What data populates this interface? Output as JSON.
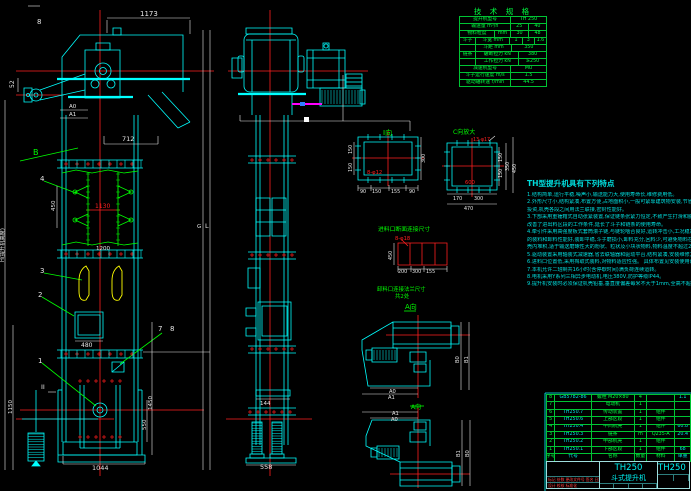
{
  "colors": {
    "background": "#000000",
    "line_cyan": "#00ffff",
    "line_green": "#00ff00",
    "line_red": "#ff1f1f",
    "line_yellow": "#ffff00",
    "line_magenta": "#ff00ff",
    "dim_white": "#e8e8e8",
    "table_green": "#00ff41"
  },
  "tech_table": {
    "title": "技 术 规 格",
    "rows": [
      [
        [
          "提升机型号",
          13
        ],
        [
          "TH 250",
          9
        ]
      ],
      [
        [
          "输送量 m³/h",
          13
        ],
        [
          "25",
          4.5
        ],
        [
          "40",
          4.5
        ]
      ],
      [
        [
          "物料粒度",
          9
        ],
        [
          "mm",
          4
        ],
        [
          "30",
          4.5
        ],
        [
          "48",
          4.5
        ]
      ],
      [
        [
          "斗子",
          4
        ],
        [
          "斗宽 mm",
          9
        ],
        [
          "1",
          3
        ],
        [
          "3",
          3
        ],
        [
          "1.6",
          3
        ]
      ],
      [
        [
          "",
          4
        ],
        [
          "斗距 mm",
          9
        ],
        [
          "350",
          9
        ]
      ],
      [
        [
          "链条",
          4
        ],
        [
          "破断拉力 kN",
          11
        ],
        [
          "380",
          7
        ]
      ],
      [
        [
          "",
          4
        ],
        [
          "工作拉力 kN",
          11
        ],
        [
          "≥250",
          7
        ]
      ],
      [
        [
          "减速机型号",
          13
        ],
        [
          "MU",
          9
        ]
      ],
      [
        [
          "斗子运行速度 m/s",
          13
        ],
        [
          "1.5",
          9
        ]
      ],
      [
        [
          "驱动轴转速 r/min",
          13
        ],
        [
          "44.5",
          9
        ]
      ]
    ]
  },
  "features": {
    "title": "TH型提升机具有下列特点",
    "lines": [
      "1.结构简单,运行平稳,噪声小,输送能力大,使用寿命长,维修费用低。",
      "2.外形尺寸小,结构紧凑,布置方便,占地面积小,一般可紧靠建筑物安装,节省基建",
      "  投资,机壳各段之间用法兰联接,密封性能好。",
      "3.下部采用重锤箱式自动张紧装置,保证链条张紧力恒定,不致产生打滑和脱链,大大",
      "  改善了进出料区段的工作条件,延长了斗子和链条的使用寿命。",
      "4.牵引件采用高强度板式套筒滚子链,与链轮啮合良好,运转冲击小,工况稳定。斗子",
      "  的装料和卸料性能好,装卸平稳,斗子磨损小,卸料充分,回料少,可避免物料在机",
      "  壳内堆积,适于输送磨琢性大的粉状、粒状及小块状物料,物料温度不超过250℃。",
      "5.驱动装置采用轴装式减速器,省去联轴器和驱动平台,结构紧凑,安装维修方便,运行可靠。",
      "6.进料口位置低,采用掏取式装料,对物料适应性强。      具体布置见安装使用说明书",
      "7.本机允许二班制共16小时(含停歇时间)满负荷连续运转。",
      "8.电机采用Y系列三相异步电动机,电压380V,防护等级IP44。",
      "9.提升机安装时必须保证机壳铅垂,垂直度偏差每米不大于1mm,全高不超过8mm。"
    ]
  },
  "bom": {
    "rows": [
      [
        "8",
        "GB5782-86",
        "螺栓 M20×80",
        "4",
        "",
        "1.1"
      ],
      [
        "7",
        "",
        "电动机",
        "1",
        "",
        ""
      ],
      [
        "6",
        "TH250.7",
        "传动装置",
        "1",
        "组件",
        ""
      ],
      [
        "5",
        "TH250.6",
        "上部区段",
        "1",
        "组件",
        ""
      ],
      [
        "4",
        "TH250.4",
        "中间机壳",
        "1",
        "组件",
        "60.8"
      ],
      [
        "3",
        "TH250.3",
        "链条",
        "m",
        "Q235-A",
        "20.4"
      ],
      [
        "2",
        "TH250.2",
        "中部机壳",
        "1",
        "组件",
        ""
      ],
      [
        "1",
        "TH250.1",
        "下部区段",
        "1",
        "组件",
        "68"
      ],
      [
        "序号",
        "代号",
        "名称",
        "数量",
        "材料",
        "单重"
      ]
    ]
  },
  "title_block": {
    "model": "TH250",
    "name": "斗式提升机",
    "model_right": "TH250",
    "rev_row1": "标记 处数 更改文件号 签名 日期",
    "rev_row2": "设计  校核  标准化"
  },
  "labels": [
    {
      "t": "1173",
      "x": 140,
      "y": 16,
      "c": "w"
    },
    {
      "t": "8",
      "x": 37,
      "y": 24,
      "c": "w"
    },
    {
      "t": "52",
      "x": 14,
      "y": 88,
      "c": "w",
      "r": -90,
      "s": 6
    },
    {
      "t": "A0",
      "x": 69,
      "y": 108,
      "c": "w",
      "s": 5.5
    },
    {
      "t": "A1",
      "x": 69,
      "y": 116,
      "c": "w",
      "s": 5.5
    },
    {
      "t": "712",
      "x": 122,
      "y": 141,
      "c": "w",
      "s": 6.5
    },
    {
      "t": "B",
      "x": 33,
      "y": 155,
      "c": "g",
      "s": 8
    },
    {
      "t": "4",
      "x": 40,
      "y": 181,
      "c": "w"
    },
    {
      "t": "450",
      "x": 55,
      "y": 211,
      "c": "w",
      "r": -90,
      "s": 5.5
    },
    {
      "t": "1130",
      "x": 95,
      "y": 208,
      "c": "r",
      "s": 6
    },
    {
      "t": "1200",
      "x": 96,
      "y": 250,
      "c": "w",
      "s": 5.5
    },
    {
      "t": "3",
      "x": 40,
      "y": 273,
      "c": "w"
    },
    {
      "t": "2",
      "x": 38,
      "y": 297,
      "c": "w"
    },
    {
      "t": "480",
      "x": 81,
      "y": 347,
      "c": "w",
      "s": 6
    },
    {
      "t": "7",
      "x": 158,
      "y": 331,
      "c": "w"
    },
    {
      "t": "8",
      "x": 170,
      "y": 331,
      "c": "w"
    },
    {
      "t": "1",
      "x": 38,
      "y": 363,
      "c": "w"
    },
    {
      "t": "II",
      "x": 41,
      "y": 389,
      "c": "w",
      "s": 6.5
    },
    {
      "t": "H(提升机高度)",
      "x": 4,
      "y": 262,
      "c": "w",
      "s": 5.2,
      "r": -90
    },
    {
      "t": "1150",
      "x": 12,
      "y": 414,
      "c": "w",
      "s": 5.5,
      "r": -90
    },
    {
      "t": "1450",
      "x": 152,
      "y": 410,
      "c": "w",
      "s": 5.5,
      "r": -90
    },
    {
      "t": "550",
      "x": 146,
      "y": 430,
      "c": "w",
      "s": 5.5,
      "r": -90
    },
    {
      "t": "1044",
      "x": 92,
      "y": 470,
      "c": "w",
      "s": 6.5
    },
    {
      "t": "G",
      "x": 197,
      "y": 228,
      "c": "w",
      "s": 5.5
    },
    {
      "t": "L",
      "x": 205,
      "y": 228,
      "c": "w",
      "s": 6.5
    },
    {
      "t": "558",
      "x": 260,
      "y": 469,
      "c": "w",
      "s": 6.5
    },
    {
      "t": "144",
      "x": 260,
      "y": 405,
      "c": "w",
      "s": 5.5
    },
    {
      "t": "I向",
      "x": 383,
      "y": 135,
      "c": "g",
      "s": 7
    },
    {
      "t": "8-φ12",
      "x": 367,
      "y": 174,
      "c": "r",
      "s": 5.2
    },
    {
      "t": "150",
      "x": 352,
      "y": 154,
      "c": "w",
      "s": 4.8,
      "r": -90
    },
    {
      "t": "150",
      "x": 352,
      "y": 172,
      "c": "w",
      "s": 4.8,
      "r": -90
    },
    {
      "t": "300",
      "x": 425,
      "y": 163,
      "c": "w",
      "s": 4.8,
      "r": -90
    },
    {
      "t": "90",
      "x": 360,
      "y": 193,
      "c": "w",
      "s": 4.8
    },
    {
      "t": "150",
      "x": 372,
      "y": 193,
      "c": "w",
      "s": 4.8
    },
    {
      "t": "155",
      "x": 391,
      "y": 193,
      "c": "w",
      "s": 4.8
    },
    {
      "t": "90",
      "x": 409,
      "y": 193,
      "c": "w",
      "s": 4.8
    },
    {
      "t": "C向放大",
      "x": 453,
      "y": 134,
      "c": "g",
      "s": 6
    },
    {
      "t": "13-φ17",
      "x": 473,
      "y": 141,
      "c": "r",
      "s": 4.8
    },
    {
      "t": "600",
      "x": 465,
      "y": 184,
      "c": "r",
      "s": 5.2
    },
    {
      "t": "170",
      "x": 453,
      "y": 200,
      "c": "w",
      "s": 4.8
    },
    {
      "t": "300",
      "x": 474,
      "y": 200,
      "c": "w",
      "s": 4.8
    },
    {
      "t": "470",
      "x": 464,
      "y": 210,
      "c": "w",
      "s": 4.8
    },
    {
      "t": "150",
      "x": 502,
      "y": 162,
      "c": "w",
      "s": 4.8,
      "r": -90
    },
    {
      "t": "150",
      "x": 502,
      "y": 178,
      "c": "w",
      "s": 4.8,
      "r": -90
    },
    {
      "t": "350",
      "x": 509,
      "y": 171,
      "c": "w",
      "s": 4.8,
      "r": -90
    },
    {
      "t": "450",
      "x": 516,
      "y": 173,
      "c": "w",
      "s": 4.8,
      "r": -90
    },
    {
      "t": "进料口断面连接尺寸",
      "x": 378,
      "y": 231,
      "c": "g",
      "s": 5.8
    },
    {
      "t": "8-φ18",
      "x": 395,
      "y": 240,
      "c": "r",
      "s": 5.2
    },
    {
      "t": "450",
      "x": 392,
      "y": 260,
      "c": "w",
      "s": 4.8,
      "r": -90
    },
    {
      "t": "200",
      "x": 398,
      "y": 273,
      "c": "w",
      "s": 4.8
    },
    {
      "t": "300",
      "x": 412,
      "y": 273,
      "c": "w",
      "s": 4.8
    },
    {
      "t": "155",
      "x": 426,
      "y": 273,
      "c": "w",
      "s": 4.8
    },
    {
      "t": "卸料口连接法兰尺寸",
      "x": 377,
      "y": 291,
      "c": "g",
      "s": 5.4
    },
    {
      "t": "共2处",
      "x": 395,
      "y": 298,
      "c": "g",
      "s": 5.4
    },
    {
      "t": "A向",
      "x": 405,
      "y": 309,
      "c": "g",
      "s": 7
    },
    {
      "t": "B0",
      "x": 459,
      "y": 363,
      "c": "w",
      "s": 5.2,
      "r": -90
    },
    {
      "t": "B1",
      "x": 468,
      "y": 363,
      "c": "w",
      "s": 5.2,
      "r": -90
    },
    {
      "t": "A0",
      "x": 389,
      "y": 393,
      "c": "w",
      "s": 5.2
    },
    {
      "t": "A1",
      "x": 388,
      "y": 399,
      "c": "w",
      "s": 5.2
    },
    {
      "t": "A向",
      "x": 411,
      "y": 409,
      "c": "g",
      "s": 6
    },
    {
      "t": "A1",
      "x": 392,
      "y": 415,
      "c": "w",
      "s": 5.2
    },
    {
      "t": "A0",
      "x": 391,
      "y": 421,
      "c": "w",
      "s": 5.2
    },
    {
      "t": "B1",
      "x": 460,
      "y": 457,
      "c": "w",
      "s": 5.2,
      "r": -90
    },
    {
      "t": "B0",
      "x": 469,
      "y": 457,
      "c": "w",
      "s": 5.2,
      "r": -90
    }
  ]
}
